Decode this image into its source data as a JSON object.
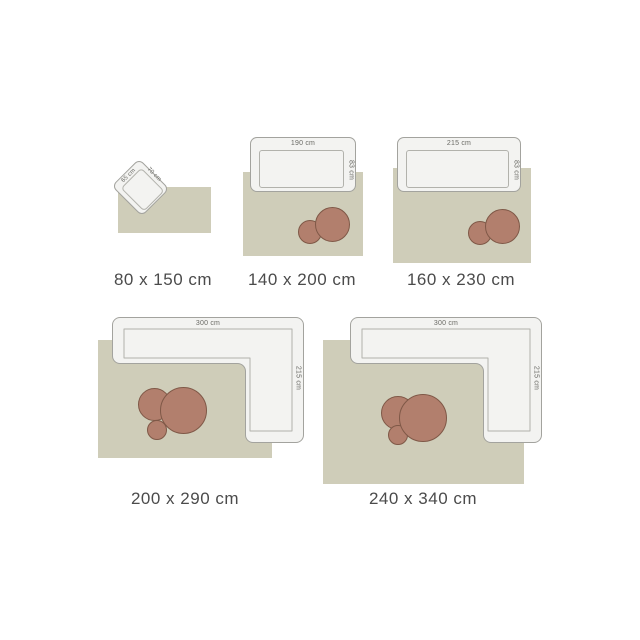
{
  "palette": {
    "background": "#ffffff",
    "rug": "#cfcdb9",
    "sofa_fill": "#f3f3f1",
    "sofa_border": "#a3a39e",
    "seat_border": "#b2b2ac",
    "table_fill": "#b27f6d",
    "table_border": "#7f5847",
    "caption_color": "#4b4b4b",
    "dim_color": "#6a6a65"
  },
  "rugs": [
    {
      "caption": "80 x 150 cm",
      "furniture": "armchair",
      "furniture_width": "65 cm",
      "furniture_depth": "70 cm"
    },
    {
      "caption": "140 x 200 cm",
      "furniture": "sofa",
      "furniture_width": "190 cm",
      "furniture_depth": "83 cm"
    },
    {
      "caption": "160 x 230 cm",
      "furniture": "sofa",
      "furniture_width": "215 cm",
      "furniture_depth": "83 cm"
    },
    {
      "caption": "200 x 290 cm",
      "furniture": "corner-sofa",
      "furniture_width": "300 cm",
      "furniture_depth": "215 cm"
    },
    {
      "caption": "240 x 340 cm",
      "furniture": "corner-sofa",
      "furniture_width": "300 cm",
      "furniture_depth": "215 cm"
    }
  ]
}
